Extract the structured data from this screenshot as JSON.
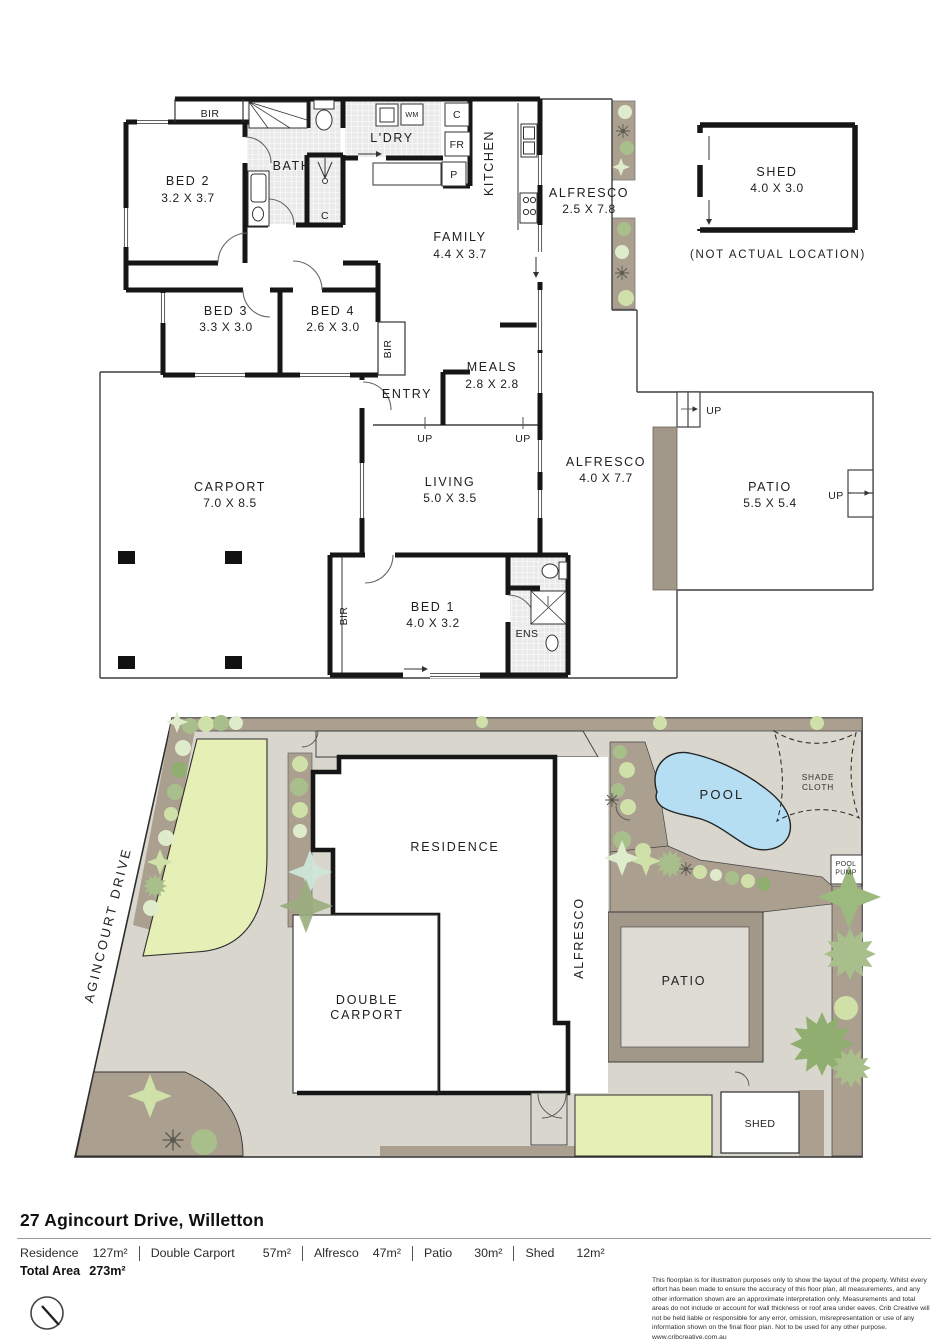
{
  "floorplan": {
    "rooms": {
      "bed2": {
        "name": "BED 2",
        "dims": "3.2 X 3.7"
      },
      "bed3": {
        "name": "BED 3",
        "dims": "3.3 X 3.0"
      },
      "bed4": {
        "name": "BED 4",
        "dims": "2.6 X 3.0"
      },
      "bed1": {
        "name": "BED 1",
        "dims": "4.0 X 3.2"
      },
      "bath": {
        "name": "BATH"
      },
      "ens": {
        "name": "ENS"
      },
      "ldry": {
        "name": "L'DRY"
      },
      "kitchen": {
        "name": "KITCHEN"
      },
      "family": {
        "name": "FAMILY",
        "dims": "4.4 X 3.7"
      },
      "meals": {
        "name": "MEALS",
        "dims": "2.8 X 2.8"
      },
      "entry": {
        "name": "ENTRY"
      },
      "living": {
        "name": "LIVING",
        "dims": "5.0 X 3.5"
      },
      "carport": {
        "name": "CARPORT",
        "dims": "7.0 X 8.5"
      },
      "alfresco_rear": {
        "name": "ALFRESCO",
        "dims": "2.5 X 7.8"
      },
      "alfresco_side": {
        "name": "ALFRESCO",
        "dims": "4.0 X 7.7"
      },
      "patio": {
        "name": "PATIO",
        "dims": "5.5 X 5.4"
      },
      "shed": {
        "name": "SHED",
        "dims": "4.0 X 3.0",
        "note": "(NOT ACTUAL LOCATION)"
      }
    },
    "tags": {
      "bir": "BIR",
      "up": "UP",
      "linen": "C",
      "fridge": "FR",
      "pantry": "P",
      "wm": "WM"
    }
  },
  "siteplan": {
    "street": "AGINCOURT DRIVE",
    "residence": "RESIDENCE",
    "double_carport": "DOUBLE\nCARPORT",
    "alfresco": "ALFRESCO",
    "patio": "PATIO",
    "pool": "POOL",
    "shade_cloth": "SHADE\nCLOTH",
    "pool_pump": "POOL\nPUMP",
    "shed": "SHED"
  },
  "footer": {
    "address": "27 Agincourt Drive, Willetton",
    "areas": [
      {
        "label": "Residence",
        "value": "127m²"
      },
      {
        "label": "Double Carport",
        "value": "57m²"
      },
      {
        "label": "Alfresco",
        "value": "47m²"
      },
      {
        "label": "Patio",
        "value": "30m²"
      },
      {
        "label": "Shed",
        "value": "12m²"
      }
    ],
    "total_label": "Total Area",
    "total_value": "273m²",
    "disclaimer": "This floorplan is for illustration purposes only to show the layout of the property. Whilst every effort has been made to ensure the accuracy of this floor plan, all measurements, and any other information shown are an approximate interpretation only. Measurements and total areas do not include or account for wall thickness or roof area under eaves. Crib Creative will not be held liable or responsible for any error, omission, misrepresentation or use of any information shown on the final floor plan. Not to be used for any other purpose.",
    "website": "www.cribcreative.com.au"
  },
  "colors": {
    "wall": "#161616",
    "lot": "#d9d6ce",
    "tan": "#ab9f90",
    "tandark": "#a2988a",
    "lawn": "#e6efb5",
    "pool": "#b5def2",
    "olive": "#a9bf8b",
    "lightgreen": "#cfe0a8",
    "palegreen": "#dfeccc",
    "green": "#8fae6f"
  }
}
